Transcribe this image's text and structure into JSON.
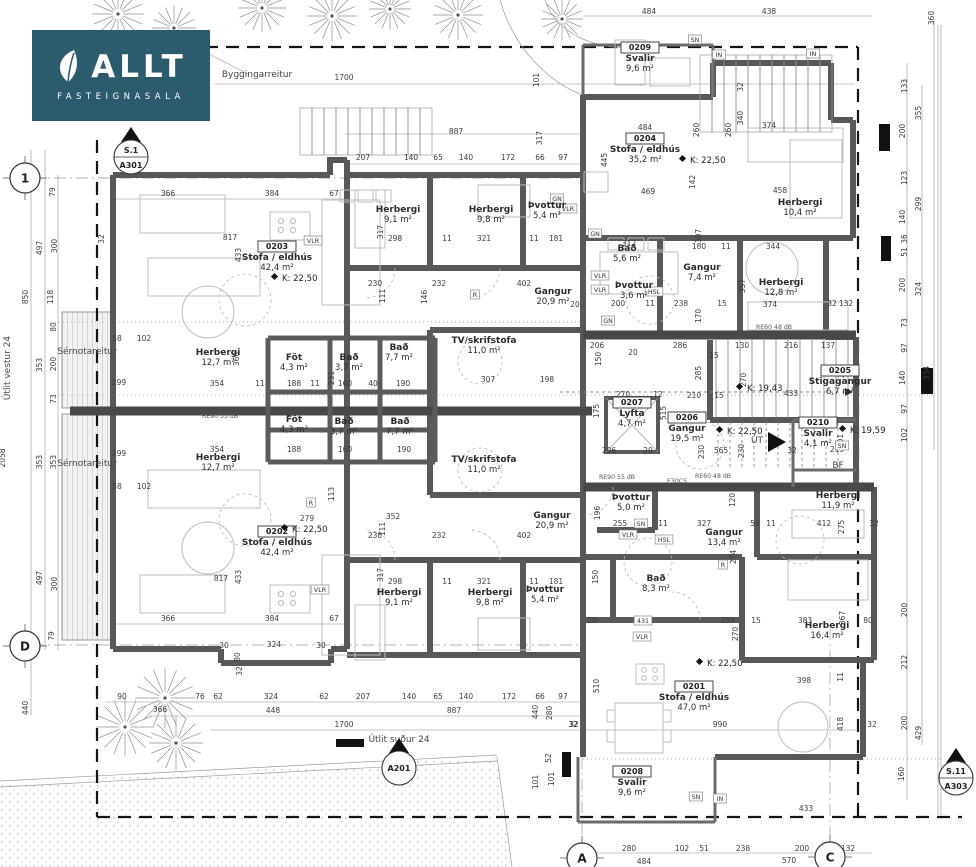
{
  "logo": {
    "brand": "ALLT",
    "subtitle": "FASTEIGNASALA",
    "bg_color": "#2d5b6e",
    "icon": "leaf-icon"
  },
  "drawing": {
    "type": "architectural-floor-plan",
    "view_labels": {
      "west": "Útlit vestur 24",
      "south": "Útlit suður 24"
    }
  },
  "rooms": [
    {
      "id": "0203",
      "name": "Stofa / eldhús",
      "area": "42,4 m²",
      "x": 277,
      "y": 249
    },
    {
      "id": "0202",
      "name": "Stofa / eldhús",
      "area": "42,4 m²",
      "x": 277,
      "y": 534
    },
    {
      "id": "0204",
      "name": "Stofa / eldhús",
      "area": "35,2 m²",
      "x": 645,
      "y": 141
    },
    {
      "id": "0201",
      "name": "Stofa / eldhús",
      "area": "47,0 m²",
      "x": 694,
      "y": 689
    },
    {
      "id": "0209",
      "name": "Svalir",
      "area": "9,6 m²",
      "x": 640,
      "y": 50
    },
    {
      "id": "0208",
      "name": "Svalir",
      "area": "9,6 m²",
      "x": 632,
      "y": 774
    },
    {
      "id": "0210",
      "name": "Svalir",
      "area": "4,1 m²",
      "x": 818,
      "y": 425
    },
    {
      "id": "0205",
      "name": "Stigagangur",
      "area": "6,7 m²",
      "x": 840,
      "y": 373
    },
    {
      "id": "0206",
      "name": "Gangur",
      "area": "19,5 m²",
      "x": 687,
      "y": 420
    },
    {
      "id": "0207",
      "name": "Lyfta",
      "area": "4,7 m²",
      "x": 632,
      "y": 405
    },
    {
      "name": "Herbergi",
      "area": "9,1 m²",
      "x": 398,
      "y": 212
    },
    {
      "name": "Herbergi",
      "area": "9,8 m²",
      "x": 491,
      "y": 212
    },
    {
      "name": "Þvottur",
      "area": "5,4 m²",
      "x": 547,
      "y": 208
    },
    {
      "name": "Herbergi",
      "area": "12,7 m²",
      "x": 218,
      "y": 355
    },
    {
      "name": "Herbergi",
      "area": "12,7 m²",
      "x": 218,
      "y": 460
    },
    {
      "name": "Föt",
      "area": "4,3 m²",
      "x": 294,
      "y": 360
    },
    {
      "name": "Föt",
      "area": "4,3 m²",
      "x": 294,
      "y": 422
    },
    {
      "name": "Bað",
      "area": "3,7 m²",
      "x": 349,
      "y": 360
    },
    {
      "name": "Bað",
      "area": "3,7 m²",
      "x": 344,
      "y": 424
    },
    {
      "name": "Bað",
      "area": "7,7 m²",
      "x": 399,
      "y": 350
    },
    {
      "name": "Bað",
      "area": "7,7 m²",
      "x": 400,
      "y": 424
    },
    {
      "name": "TV/skrifstofa",
      "area": "11,0 m²",
      "x": 484,
      "y": 343
    },
    {
      "name": "TV/skrifstofa",
      "area": "11,0 m²",
      "x": 484,
      "y": 462
    },
    {
      "name": "Gangur",
      "area": "20,9 m²",
      "x": 553,
      "y": 294
    },
    {
      "name": "Gangur",
      "area": "20,9 m²",
      "x": 552,
      "y": 518
    },
    {
      "name": "Bað",
      "area": "5,6 m²",
      "x": 627,
      "y": 251
    },
    {
      "name": "Þvottur",
      "area": "3,6 m²",
      "x": 634,
      "y": 288
    },
    {
      "name": "Gangur",
      "area": "7,4 m²",
      "x": 702,
      "y": 270
    },
    {
      "name": "Herbergi",
      "area": "12,8 m²",
      "x": 781,
      "y": 285
    },
    {
      "name": "Herbergi",
      "area": "10,4 m²",
      "x": 800,
      "y": 205
    },
    {
      "name": "Herbergi",
      "area": "9,1 m²",
      "x": 399,
      "y": 595
    },
    {
      "name": "Herbergi",
      "area": "9,8 m²",
      "x": 490,
      "y": 595
    },
    {
      "name": "Þvottur",
      "area": "5,4 m²",
      "x": 545,
      "y": 592
    },
    {
      "name": "Þvottur",
      "area": "5,0 m²",
      "x": 631,
      "y": 500
    },
    {
      "name": "Gangur",
      "area": "13,4 m²",
      "x": 724,
      "y": 535
    },
    {
      "name": "Bað",
      "area": "8,3 m²",
      "x": 656,
      "y": 581
    },
    {
      "name": "Herbergi",
      "area": "11,9 m²",
      "x": 838,
      "y": 498
    },
    {
      "name": "Herbergi",
      "area": "16,4 m²",
      "x": 827,
      "y": 628
    }
  ],
  "k_labels": [
    {
      "t": "K: 22,50",
      "x": 282,
      "y": 281
    },
    {
      "t": "K: 22,50",
      "x": 292,
      "y": 532
    },
    {
      "t": "K: 22,50",
      "x": 690,
      "y": 163
    },
    {
      "t": "K: 22,50",
      "x": 727,
      "y": 434
    },
    {
      "t": "K: 22,50",
      "x": 707,
      "y": 666
    },
    {
      "t": "K: 19,43",
      "x": 747,
      "y": 391
    },
    {
      "t": "K: 19,59",
      "x": 850,
      "y": 433
    }
  ],
  "annotations": [
    {
      "t": "Byggingarreitur",
      "x": 257,
      "y": 77
    },
    {
      "t": "Sérnotareitur",
      "x": 87,
      "y": 354
    },
    {
      "t": "Sérnotareitur",
      "x": 87,
      "y": 466
    },
    {
      "t": "Útlit vestur 24",
      "x": 10,
      "y": 368,
      "r": 1
    },
    {
      "t": "Útlit suður 24",
      "x": 399,
      "y": 742
    },
    {
      "t": "BF",
      "x": 838,
      "y": 468
    },
    {
      "t": "ÚT",
      "x": 757,
      "y": 443
    }
  ],
  "markers": [
    {
      "top": "S.1",
      "bot": "A301",
      "x": 131,
      "y": 157
    },
    {
      "top": "",
      "bot": "A201",
      "x": 399,
      "y": 768
    },
    {
      "top": "S.11",
      "bot": "A303",
      "x": 956,
      "y": 778
    }
  ],
  "grid_bubbles": [
    {
      "t": "1",
      "x": 25,
      "y": 178
    },
    {
      "t": "D",
      "x": 25,
      "y": 646
    },
    {
      "t": "A",
      "x": 582,
      "y": 858
    },
    {
      "t": "C",
      "x": 830,
      "y": 857
    }
  ],
  "wall_tags": [
    {
      "t": "VLR",
      "x": 313,
      "y": 243
    },
    {
      "t": "GN",
      "x": 557,
      "y": 201
    },
    {
      "t": "VLR",
      "x": 568,
      "y": 211
    },
    {
      "t": "GN",
      "x": 595,
      "y": 236
    },
    {
      "t": "VLR",
      "x": 600,
      "y": 278
    },
    {
      "t": "VLR",
      "x": 600,
      "y": 292
    },
    {
      "t": "HSL",
      "x": 654,
      "y": 294
    },
    {
      "t": "GN",
      "x": 608,
      "y": 323
    },
    {
      "t": "VLR",
      "x": 628,
      "y": 537
    },
    {
      "t": "SN",
      "x": 641,
      "y": 526
    },
    {
      "t": "HSL",
      "x": 664,
      "y": 542
    },
    {
      "t": "VLR",
      "x": 642,
      "y": 639
    },
    {
      "t": "R",
      "x": 475,
      "y": 297
    },
    {
      "t": "R",
      "x": 311,
      "y": 505
    },
    {
      "t": "R",
      "x": 723,
      "y": 567
    },
    {
      "t": "SN",
      "x": 696,
      "y": 799
    },
    {
      "t": "IN",
      "x": 720,
      "y": 801
    },
    {
      "t": "SN",
      "x": 695,
      "y": 42
    },
    {
      "t": "IN",
      "x": 719,
      "y": 57
    },
    {
      "t": "IN",
      "x": 813,
      "y": 56
    },
    {
      "t": "VLR",
      "x": 320,
      "y": 592
    },
    {
      "t": "431",
      "x": 643,
      "y": 623
    },
    {
      "t": "SN",
      "x": 842,
      "y": 448
    },
    {
      "t": "E30CS",
      "x": 677,
      "y": 483,
      "plain": 1
    },
    {
      "t": "RE90 55 dB",
      "x": 617,
      "y": 479,
      "plain": 1
    },
    {
      "t": "RE90 55 dB",
      "x": 220,
      "y": 418,
      "plain": 1
    },
    {
      "t": "RE60 48 dB",
      "x": 774,
      "y": 329,
      "plain": 1
    },
    {
      "t": "RE60 48 dB",
      "x": 713,
      "y": 478,
      "plain": 1
    }
  ],
  "dimension_labels": [
    [
      "484",
      649,
      14
    ],
    [
      "438",
      769,
      14
    ],
    [
      "360",
      934,
      18,
      1
    ],
    [
      "1700",
      344,
      80
    ],
    [
      "887",
      456,
      134
    ],
    [
      "101",
      539,
      80,
      1
    ],
    [
      "317",
      542,
      138,
      1
    ],
    [
      "207",
      363,
      160
    ],
    [
      "140",
      411,
      160
    ],
    [
      "65",
      438,
      160
    ],
    [
      "140",
      466,
      160
    ],
    [
      "172",
      508,
      160
    ],
    [
      "66",
      540,
      160
    ],
    [
      "97",
      563,
      160
    ],
    [
      "79",
      55,
      192,
      1
    ],
    [
      "497",
      42,
      248,
      1
    ],
    [
      "300",
      57,
      246,
      1
    ],
    [
      "118",
      53,
      297,
      1
    ],
    [
      "850",
      28,
      297,
      1
    ],
    [
      "32",
      104,
      239,
      1
    ],
    [
      "58",
      117,
      341
    ],
    [
      "102",
      144,
      341
    ],
    [
      "299",
      119,
      385
    ],
    [
      "353",
      42,
      365,
      1
    ],
    [
      "200",
      56,
      364,
      1
    ],
    [
      "80",
      56,
      327,
      1
    ],
    [
      "73",
      56,
      399,
      1
    ],
    [
      "299",
      119,
      456
    ],
    [
      "353",
      42,
      462,
      1
    ],
    [
      "353",
      56,
      462,
      1
    ],
    [
      "58",
      117,
      489
    ],
    [
      "102",
      144,
      489
    ],
    [
      "2058",
      5,
      458,
      1
    ],
    [
      "497",
      42,
      578,
      1
    ],
    [
      "300",
      57,
      584,
      1
    ],
    [
      "79",
      54,
      636,
      1
    ],
    [
      "440",
      28,
      708,
      1
    ],
    [
      "366",
      168,
      196
    ],
    [
      "384",
      272,
      196
    ],
    [
      "67",
      334,
      196
    ],
    [
      "817",
      230,
      240
    ],
    [
      "433",
      241,
      255,
      1
    ],
    [
      "230",
      375,
      286
    ],
    [
      "232",
      439,
      286
    ],
    [
      "402",
      524,
      286
    ],
    [
      "111",
      385,
      296,
      1
    ],
    [
      "146",
      427,
      297,
      1
    ],
    [
      "317",
      383,
      232,
      1
    ],
    [
      "298",
      395,
      241
    ],
    [
      "11",
      447,
      241
    ],
    [
      "321",
      484,
      241
    ],
    [
      "11",
      534,
      241
    ],
    [
      "181",
      556,
      241
    ],
    [
      "20",
      575,
      307
    ],
    [
      "360",
      239,
      359,
      1
    ],
    [
      "354",
      217,
      386
    ],
    [
      "11",
      260,
      386
    ],
    [
      "188",
      294,
      386
    ],
    [
      "11",
      315,
      386
    ],
    [
      "160",
      345,
      386
    ],
    [
      "40",
      373,
      386
    ],
    [
      "190",
      403,
      386
    ],
    [
      "231",
      334,
      378,
      1
    ],
    [
      "354",
      217,
      452
    ],
    [
      "188",
      294,
      452
    ],
    [
      "160",
      345,
      452
    ],
    [
      "190",
      404,
      452
    ],
    [
      "113",
      334,
      494,
      1
    ],
    [
      "307",
      488,
      382
    ],
    [
      "198",
      547,
      382
    ],
    [
      "279",
      307,
      521
    ],
    [
      "352",
      393,
      519
    ],
    [
      "230",
      375,
      538
    ],
    [
      "232",
      439,
      538
    ],
    [
      "402",
      524,
      538
    ],
    [
      "111",
      385,
      529,
      1
    ],
    [
      "298",
      395,
      584
    ],
    [
      "321",
      484,
      584
    ],
    [
      "11",
      447,
      584
    ],
    [
      "181",
      556,
      584
    ],
    [
      "11",
      534,
      584
    ],
    [
      "317",
      383,
      575,
      1
    ],
    [
      "366",
      168,
      621
    ],
    [
      "384",
      272,
      621
    ],
    [
      "67",
      334,
      621
    ],
    [
      "817",
      221,
      581
    ],
    [
      "433",
      241,
      577,
      1
    ],
    [
      "324",
      274,
      647
    ],
    [
      "30",
      224,
      648
    ],
    [
      "30",
      321,
      648
    ],
    [
      "80",
      240,
      657,
      1
    ],
    [
      "32",
      242,
      671,
      1
    ],
    [
      "90",
      122,
      699
    ],
    [
      "366",
      160,
      712
    ],
    [
      "76",
      200,
      699
    ],
    [
      "62",
      218,
      699
    ],
    [
      "324",
      271,
      699
    ],
    [
      "62",
      324,
      699
    ],
    [
      "448",
      273,
      713
    ],
    [
      "1700",
      344,
      727
    ],
    [
      "207",
      363,
      699
    ],
    [
      "140",
      409,
      699
    ],
    [
      "65",
      438,
      699
    ],
    [
      "140",
      466,
      699
    ],
    [
      "172",
      509,
      699
    ],
    [
      "66",
      540,
      699
    ],
    [
      "97",
      563,
      699
    ],
    [
      "887",
      454,
      713
    ],
    [
      "440",
      538,
      712,
      1
    ],
    [
      "280",
      552,
      713,
      1
    ],
    [
      "32",
      573,
      727
    ],
    [
      "101",
      538,
      782,
      1
    ],
    [
      "101",
      554,
      779,
      1
    ],
    [
      "52",
      551,
      758,
      1
    ],
    [
      "484",
      645,
      130
    ],
    [
      "469",
      648,
      194
    ],
    [
      "445",
      607,
      160,
      1
    ],
    [
      "142",
      695,
      182,
      1
    ],
    [
      "340",
      743,
      118,
      1
    ],
    [
      "374",
      769,
      128
    ],
    [
      "260",
      699,
      130,
      1
    ],
    [
      "260",
      731,
      130,
      1
    ],
    [
      "32",
      743,
      87,
      1
    ],
    [
      "458",
      780,
      193
    ],
    [
      "312",
      629,
      246
    ],
    [
      "180",
      699,
      249
    ],
    [
      "11",
      726,
      249
    ],
    [
      "344",
      773,
      249
    ],
    [
      "307",
      701,
      236,
      1
    ],
    [
      "357",
      745,
      286,
      1
    ],
    [
      "374",
      770,
      307
    ],
    [
      "170",
      701,
      316,
      1
    ],
    [
      "238",
      681,
      306
    ],
    [
      "200",
      618,
      306
    ],
    [
      "11",
      650,
      306
    ],
    [
      "15",
      722,
      306
    ],
    [
      "132",
      846,
      306
    ],
    [
      "32",
      832,
      306
    ],
    [
      "206",
      597,
      348
    ],
    [
      "286",
      680,
      348
    ],
    [
      "130",
      742,
      348
    ],
    [
      "216",
      791,
      348
    ],
    [
      "137",
      828,
      348
    ],
    [
      "15",
      714,
      358
    ],
    [
      "285",
      701,
      373,
      1
    ],
    [
      "270",
      746,
      380,
      1
    ],
    [
      "270",
      844,
      371,
      1
    ],
    [
      "433",
      791,
      396
    ],
    [
      "210",
      694,
      398
    ],
    [
      "15",
      719,
      398
    ],
    [
      "150",
      601,
      359,
      1
    ],
    [
      "20",
      633,
      355
    ],
    [
      "270",
      623,
      397
    ],
    [
      "12",
      658,
      397
    ],
    [
      "175",
      599,
      411,
      1
    ],
    [
      "515",
      666,
      413,
      1
    ],
    [
      "219",
      837,
      452
    ],
    [
      "201",
      843,
      441,
      1
    ],
    [
      "133",
      907,
      86,
      1
    ],
    [
      "355",
      921,
      113,
      1
    ],
    [
      "200",
      905,
      131,
      1
    ],
    [
      "123",
      907,
      178,
      1
    ],
    [
      "299",
      921,
      204,
      1
    ],
    [
      "140",
      905,
      217,
      1
    ],
    [
      "36",
      907,
      239,
      1
    ],
    [
      "51",
      907,
      252,
      1
    ],
    [
      "200",
      905,
      285,
      1
    ],
    [
      "324",
      921,
      289,
      1
    ],
    [
      "73",
      907,
      323,
      1
    ],
    [
      "97",
      907,
      348,
      1
    ],
    [
      "140",
      905,
      378,
      1
    ],
    [
      "334",
      929,
      373,
      1
    ],
    [
      "97",
      907,
      409,
      1
    ],
    [
      "102",
      907,
      435,
      1
    ],
    [
      "200",
      907,
      610,
      1
    ],
    [
      "212",
      907,
      662,
      1
    ],
    [
      "200",
      907,
      723,
      1
    ],
    [
      "160",
      904,
      774,
      1
    ],
    [
      "429",
      921,
      733,
      1
    ],
    [
      "206",
      609,
      453
    ],
    [
      "20",
      648,
      453
    ],
    [
      "565",
      721,
      453
    ],
    [
      "230",
      704,
      452,
      1
    ],
    [
      "230",
      744,
      451,
      1
    ],
    [
      "32",
      792,
      453
    ],
    [
      "255",
      620,
      526
    ],
    [
      "11",
      663,
      526
    ],
    [
      "327",
      704,
      526
    ],
    [
      "56",
      755,
      526
    ],
    [
      "11",
      771,
      526
    ],
    [
      "412",
      824,
      526
    ],
    [
      "275",
      844,
      527,
      1
    ],
    [
      "32",
      874,
      526
    ],
    [
      "196",
      600,
      513,
      1
    ],
    [
      "120",
      735,
      500,
      1
    ],
    [
      "274",
      736,
      557,
      1
    ],
    [
      "150",
      598,
      577,
      1
    ],
    [
      "20",
      592,
      623
    ],
    [
      "151",
      728,
      623
    ],
    [
      "15",
      756,
      623
    ],
    [
      "383",
      805,
      623
    ],
    [
      "80",
      868,
      623
    ],
    [
      "270",
      738,
      634,
      1
    ],
    [
      "367",
      845,
      618,
      1
    ],
    [
      "398",
      804,
      683
    ],
    [
      "418",
      843,
      724,
      1
    ],
    [
      "11",
      843,
      677,
      1
    ],
    [
      "510",
      599,
      686,
      1
    ],
    [
      "990",
      720,
      727
    ],
    [
      "32",
      574,
      727
    ],
    [
      "32",
      872,
      727
    ],
    [
      "433",
      806,
      811
    ],
    [
      "280",
      629,
      851
    ],
    [
      "102",
      682,
      851
    ],
    [
      "51",
      704,
      851
    ],
    [
      "238",
      743,
      851
    ],
    [
      "200",
      802,
      851
    ],
    [
      "132",
      848,
      851
    ],
    [
      "484",
      644,
      864
    ],
    [
      "570",
      789,
      863
    ]
  ],
  "trees": [
    [
      118,
      14,
      26
    ],
    [
      174,
      28,
      22
    ],
    [
      262,
      8,
      24
    ],
    [
      332,
      16,
      25
    ],
    [
      390,
      9,
      21
    ],
    [
      458,
      15,
      25
    ],
    [
      562,
      19,
      21
    ],
    [
      165,
      698,
      30
    ],
    [
      125,
      727,
      29
    ],
    [
      176,
      743,
      27
    ]
  ]
}
